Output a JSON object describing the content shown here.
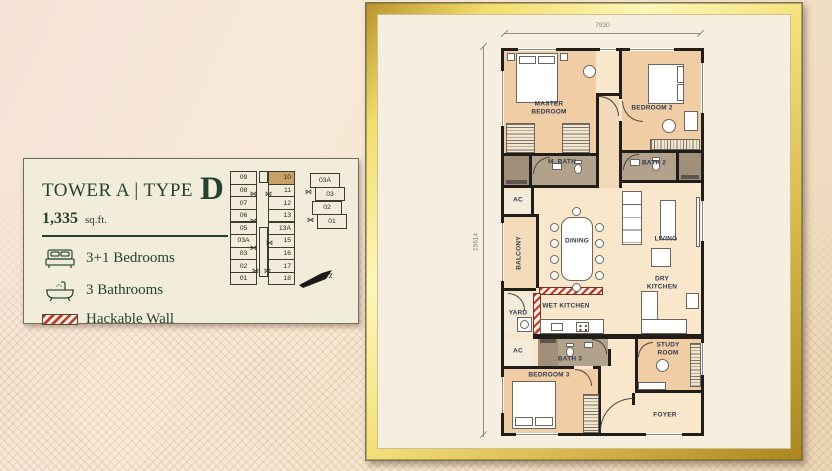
{
  "card": {
    "title_prefix": "TOWER A | TYPE",
    "title_type": "D",
    "area_value": "1,335",
    "area_unit": "sq.ft.",
    "features": [
      {
        "icon": "bed-icon",
        "label": "3+1 Bedrooms"
      },
      {
        "icon": "bathtub-icon",
        "label": "3 Bathrooms"
      },
      {
        "icon": "hackable-wall-icon",
        "label": "Hackable Wall"
      }
    ],
    "keyplan": {
      "left_column": [
        "09",
        "08",
        "07",
        "06",
        "05",
        "03A",
        "03",
        "02",
        "01"
      ],
      "right_column": [
        "10",
        "11",
        "12",
        "13",
        "13A",
        "15",
        "16",
        "17",
        "18"
      ],
      "annex_column": [
        "03A",
        "03",
        "02",
        "01"
      ],
      "highlighted_unit": "10",
      "north_arrow_label": "z"
    }
  },
  "floorplan": {
    "dim_top": "7930",
    "dim_left": "15614",
    "rooms": [
      {
        "name": "master-bedroom",
        "label": "MASTER\nBEDROOM"
      },
      {
        "name": "bedroom-2",
        "label": "BEDROOM 2"
      },
      {
        "name": "m-bath",
        "label": "M. BATH"
      },
      {
        "name": "bath-2",
        "label": "BATH 2"
      },
      {
        "name": "ac-upper",
        "label": "AC"
      },
      {
        "name": "balcony",
        "label": "BALCONY"
      },
      {
        "name": "dining",
        "label": "DINING"
      },
      {
        "name": "living",
        "label": "LIVING"
      },
      {
        "name": "dry-kitchen",
        "label": "DRY KITCHEN"
      },
      {
        "name": "wet-kitchen",
        "label": "WET KITCHEN"
      },
      {
        "name": "yard",
        "label": "YARD"
      },
      {
        "name": "ac-lower",
        "label": "AC"
      },
      {
        "name": "bath-3",
        "label": "BATH 3"
      },
      {
        "name": "bedroom-3",
        "label": "BEDROOM 3"
      },
      {
        "name": "study-room",
        "label": "STUDY\nROOM"
      },
      {
        "name": "foyer",
        "label": "FOYER"
      }
    ]
  },
  "colors": {
    "accent_green": "#26422f",
    "highlight_tan": "#c7a168",
    "hackable_red": "#c03a31",
    "frame_gold": "#e8cf62",
    "wall_black": "#201d1a"
  }
}
